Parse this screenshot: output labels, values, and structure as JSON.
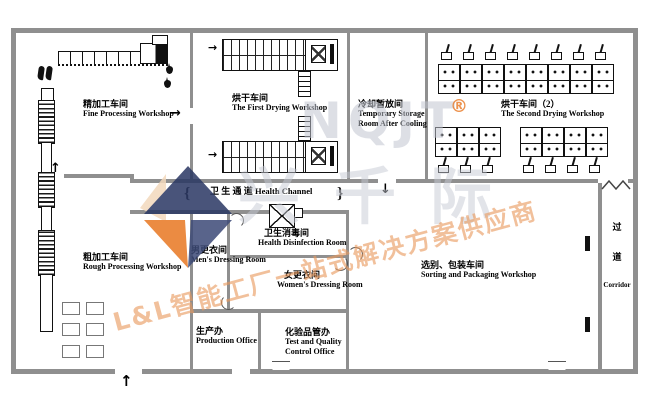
{
  "diagram": {
    "rooms": {
      "fine_processing": {
        "cn": "精加工车间",
        "en": "Fine Processing Workshop"
      },
      "first_drying": {
        "cn": "烘干车间",
        "en": "The First Drying Workshop"
      },
      "temporary_storage": {
        "cn": "冷却暂放间",
        "en_line1": "Temporary Storage",
        "en_line2": "Room After Cooling"
      },
      "second_drying": {
        "cn": "烘干车间（2）",
        "en": "The Second Drying Workshop"
      },
      "health_channel": {
        "cn": "卫 生 通 道",
        "en": "Health Channel"
      },
      "health_disinfection": {
        "cn": "卫生消毒间",
        "en": "Health Disinfection Room"
      },
      "men_dressing": {
        "cn": "男更衣间",
        "en": "Men's Dressing Room"
      },
      "women_dressing": {
        "cn": "女更衣间",
        "en": "Women's Dressing Room"
      },
      "rough_processing": {
        "cn": "粗加工车间",
        "en": "Rough Processing Workshop"
      },
      "production_office": {
        "cn": "生产办",
        "en": "Production Office"
      },
      "quality_office": {
        "cn": "化验品管办",
        "en_line1": "Test and Quality",
        "en_line2": "Control Office"
      },
      "sorting_packaging": {
        "cn": "选别、包装车间",
        "en": "Sorting and Packaging Workshop"
      },
      "corridor": {
        "cn_char1": "过",
        "cn_char2": "道",
        "en": "Corridor"
      }
    },
    "icons": {
      "arrow_up": "↑",
      "arrow_down": "↓",
      "arrow_right": "→",
      "door_brace_left": "{",
      "door_brace_right": "}"
    },
    "watermark": {
      "brand_latin": "NQJT",
      "registered_mark": "®",
      "brand_cn": "兴千际",
      "slogan": "L&L智能工厂一站式解决方案供应商",
      "colors": {
        "orange": "#e87722",
        "navy": "#2a3763",
        "gray": "#c2c6d1"
      }
    }
  }
}
